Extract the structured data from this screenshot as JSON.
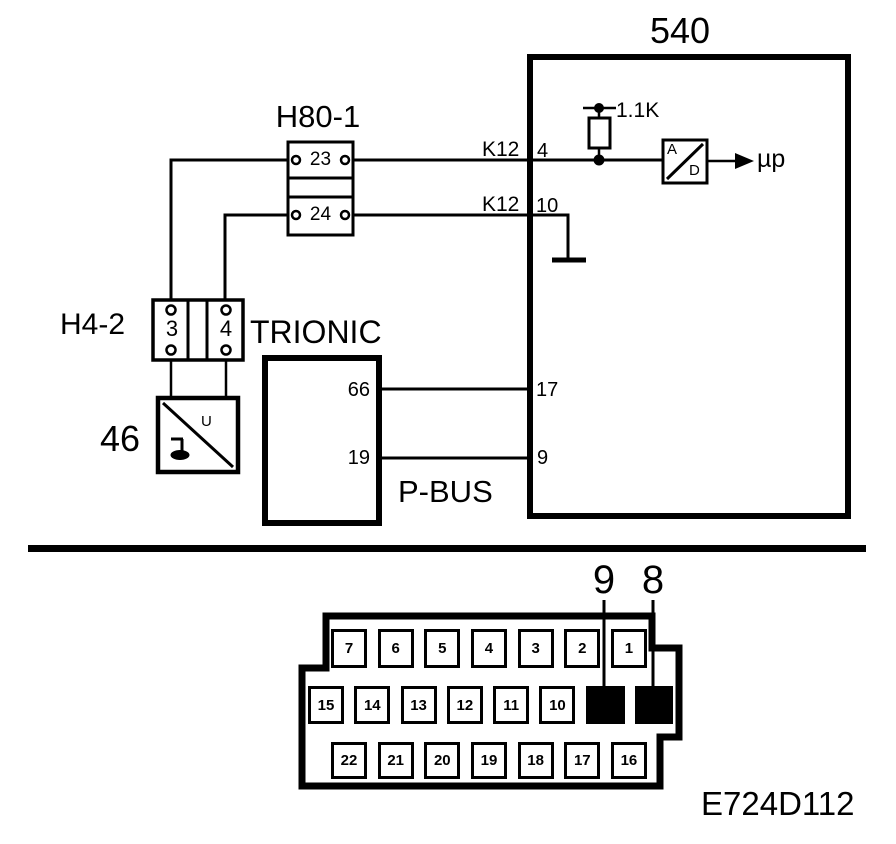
{
  "colors": {
    "ink": "#000000",
    "paper": "#ffffff"
  },
  "schematic": {
    "ecu": {
      "label": "540",
      "pin_4": "4",
      "pin_10": "10",
      "pin_17": "17",
      "pin_9": "9"
    },
    "h80_connector": {
      "label": "H80-1",
      "pin_top": "23",
      "pin_bottom": "24"
    },
    "wires": {
      "top_code": "K12",
      "bottom_code": "K12"
    },
    "resistor": {
      "value": "1.1K"
    },
    "ad_converter": {
      "letter_a": "A",
      "letter_d": "D",
      "output": "µp"
    },
    "h4_connector": {
      "label": "H4-2",
      "pin_left": "3",
      "pin_right": "4"
    },
    "sensor": {
      "label": "46",
      "symbol_u": "U"
    },
    "trionic": {
      "label": "TRIONIC",
      "pin_top": "66",
      "pin_bottom": "19"
    },
    "pbus_label": "P-BUS"
  },
  "pinout": {
    "callout_left": "9",
    "callout_right": "8",
    "row_top": [
      "7",
      "6",
      "5",
      "4",
      "3",
      "2",
      "1"
    ],
    "row_middle": [
      "15",
      "14",
      "13",
      "12",
      "11",
      "10"
    ],
    "row_bottom": [
      "22",
      "21",
      "20",
      "19",
      "18",
      "17",
      "16"
    ]
  },
  "figure_code": "E724D112"
}
